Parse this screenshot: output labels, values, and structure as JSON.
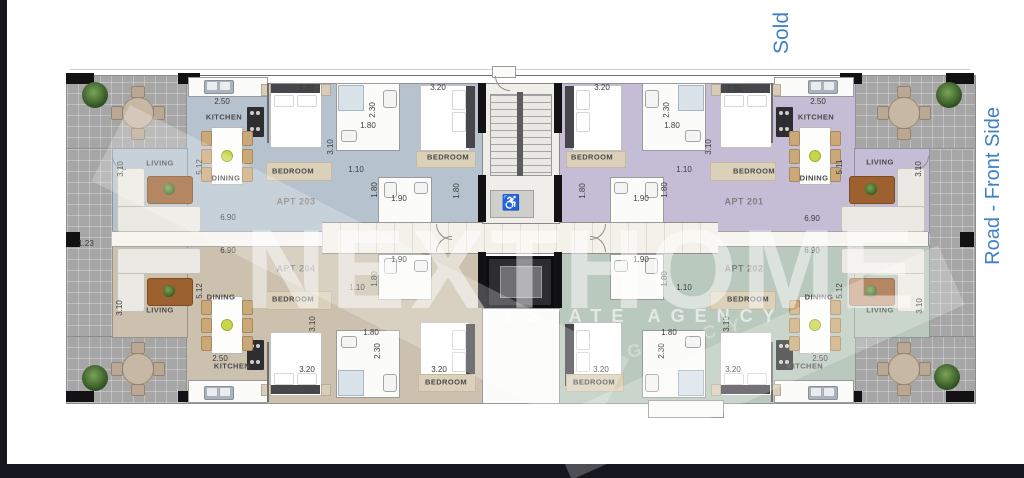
{
  "frame": {
    "sold_label": "Sold",
    "road_label": "Road - Front Side",
    "accent_blue": "#3f80c6",
    "frame_color": "#16161e"
  },
  "watermark": {
    "brand": "NEXTHOME",
    "tagline": "ESTATE AGENCY",
    "tagline_faint": "AGENCY"
  },
  "core": {
    "wheelchair": "♿"
  },
  "apartments": [
    {
      "label": "APT 203",
      "corner": "top-left",
      "floor_color": "#b6c3cf",
      "rooms": {
        "kitchen": "KITCHEN",
        "dining": "DINING",
        "living": "LIVING",
        "bed1": "BEDROOM",
        "bed2": "BEDROOM"
      },
      "dims": {
        "kitchen": "2.50",
        "living_w": "3.10",
        "living_l": "5.12",
        "overall": "6.90",
        "bed1": "3.20",
        "bed_d": "3.10",
        "bed2": "3.20",
        "bath_l": "2.30",
        "bath_w": "1.80",
        "hall": "1.10",
        "wc": "1.90",
        "wc_d": "1.80",
        "bed2_d": "1.80"
      }
    },
    {
      "label": "APT 201",
      "corner": "top-right",
      "floor_color": "#c4bdd5",
      "rooms": {
        "kitchen": "KITCHEN",
        "dining": "DINING",
        "living": "LIVING",
        "bed1": "BEDROOM",
        "bed2": "BEDROOM"
      },
      "dims": {
        "kitchen": "2.50",
        "living_w": "3.10",
        "living_l": "5.11",
        "overall": "6.90",
        "bed1": "3.20",
        "bed_d": "3.10",
        "bed2": "3.20",
        "bath_l": "2.30",
        "bath_w": "1.80",
        "hall": "1.10",
        "wc": "1.90",
        "wc_d": "1.80",
        "bed2_d": "1.80"
      }
    },
    {
      "label": "APT 204",
      "corner": "bottom-left",
      "floor_color": "#ccc1ae",
      "rooms": {
        "kitchen": "KITCHEN",
        "dining": "DINING",
        "living": "LIVING",
        "bed1": "BEDROOM",
        "bed2": "BEDROOM"
      },
      "dims": {
        "kitchen": "2.50",
        "living_w": "3.10",
        "living_l": "5.12",
        "overall": "6.90",
        "bed1": "3.20",
        "bed_d": "3.10",
        "bed2": "3.20",
        "bath_l": "2.30",
        "bath_w": "1.80",
        "hall": "1.10",
        "wc": "1.90",
        "wc_d": "1.80",
        "strip": "1.23"
      }
    },
    {
      "label": "APT 202",
      "corner": "bottom-right",
      "floor_color": "#bac9bd",
      "rooms": {
        "kitchen": "KITCHEN",
        "dining": "DINING",
        "living": "LIVING",
        "bed1": "BEDROOM",
        "bed2": "BEDROOM"
      },
      "dims": {
        "kitchen": "2.50",
        "living_w": "3.10",
        "living_l": "5.12",
        "overall": "6.90",
        "bed1": "3.20",
        "bed_d": "3.10",
        "bed2": "3.20",
        "bath_l": "2.30",
        "bath_w": "1.80",
        "hall": "1.10",
        "wc": "1.90",
        "wc_d": "1.80"
      }
    }
  ]
}
